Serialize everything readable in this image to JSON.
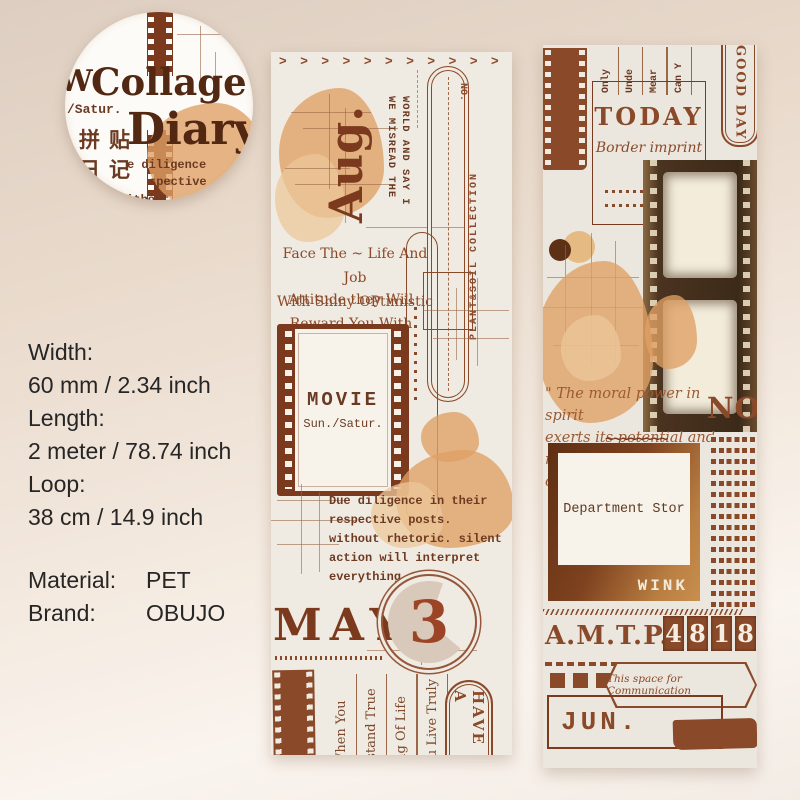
{
  "colors": {
    "accent_brown": "#7b3a1e",
    "ink_brown": "#8a4a2a",
    "stain_orange": "#dfa064",
    "bg_top": "#ddcec1",
    "bg_bottom": "#faf4ee",
    "strip_bg": "#f0ebe2"
  },
  "logo": {
    "partial_w": "W",
    "satur": "/Satur.",
    "title1": "Collage",
    "title2": "Diary",
    "cn1": "拼贴",
    "cn2": "日记",
    "tw1": "e diligence",
    "tw2": "spective",
    "tw3": "without"
  },
  "specs": {
    "items": [
      {
        "label": "Width:",
        "value": "60 mm / 2.34 inch"
      },
      {
        "label": "Length:",
        "value": "2 meter / 78.74 inch"
      },
      {
        "label": "Loop:",
        "value": "38 cm / 14.9 inch"
      }
    ],
    "material": {
      "label": "Material:",
      "value": "PET"
    },
    "brand": {
      "label": "Brand:",
      "value": "OBUJO"
    }
  },
  "left_strip": {
    "chevrons": "> > > > > > > > > > > > > > >",
    "month": "Aug.",
    "vert_line1": "WE MISREAD THE",
    "vert_line2": "WORLD AND SAY I",
    "no_label": "NO.",
    "collection": "PLANT&SOIL COLLECTION",
    "quote1_line1": "Face The ~ Life And Job",
    "quote1_line2": "With Shiny OPtimistic",
    "quote2_line1": "Attitude they Will",
    "quote2_line2": "Reward You With Sunshine",
    "movie_title": "MOVIE",
    "movie_sub": "Sun./Satur.",
    "paragraph": [
      "Due diligence in their",
      "respective posts.",
      "without rhetoric. silent",
      "action will interpret",
      "everything."
    ],
    "month2": "MAY",
    "date_number": "3",
    "phrases": [
      "When You",
      "rstand True",
      "ing Of Life",
      "ou Live Truly"
    ],
    "have_label": "HAVE A"
  },
  "right_strip": {
    "top_words": [
      "Only",
      "Unde",
      "Mear",
      "Can Y"
    ],
    "good_day": "GOOD DAY",
    "today": "TODAY",
    "today_sub": "Border imprint",
    "script_line1": "\" The moral power in spirit",
    "script_line2": "exerts its potential and",
    "script_line3": "raises its banner, so our",
    "no_label": "NO.",
    "squiggle": "~~~~~~~~",
    "photo_caption": "Department Stor",
    "wink": "WINK",
    "code_prefix": "A.M.T.P.",
    "code_digits": [
      "4",
      "8",
      "1",
      "8"
    ],
    "banner_text": "This space for Communication",
    "month": "JUN."
  }
}
